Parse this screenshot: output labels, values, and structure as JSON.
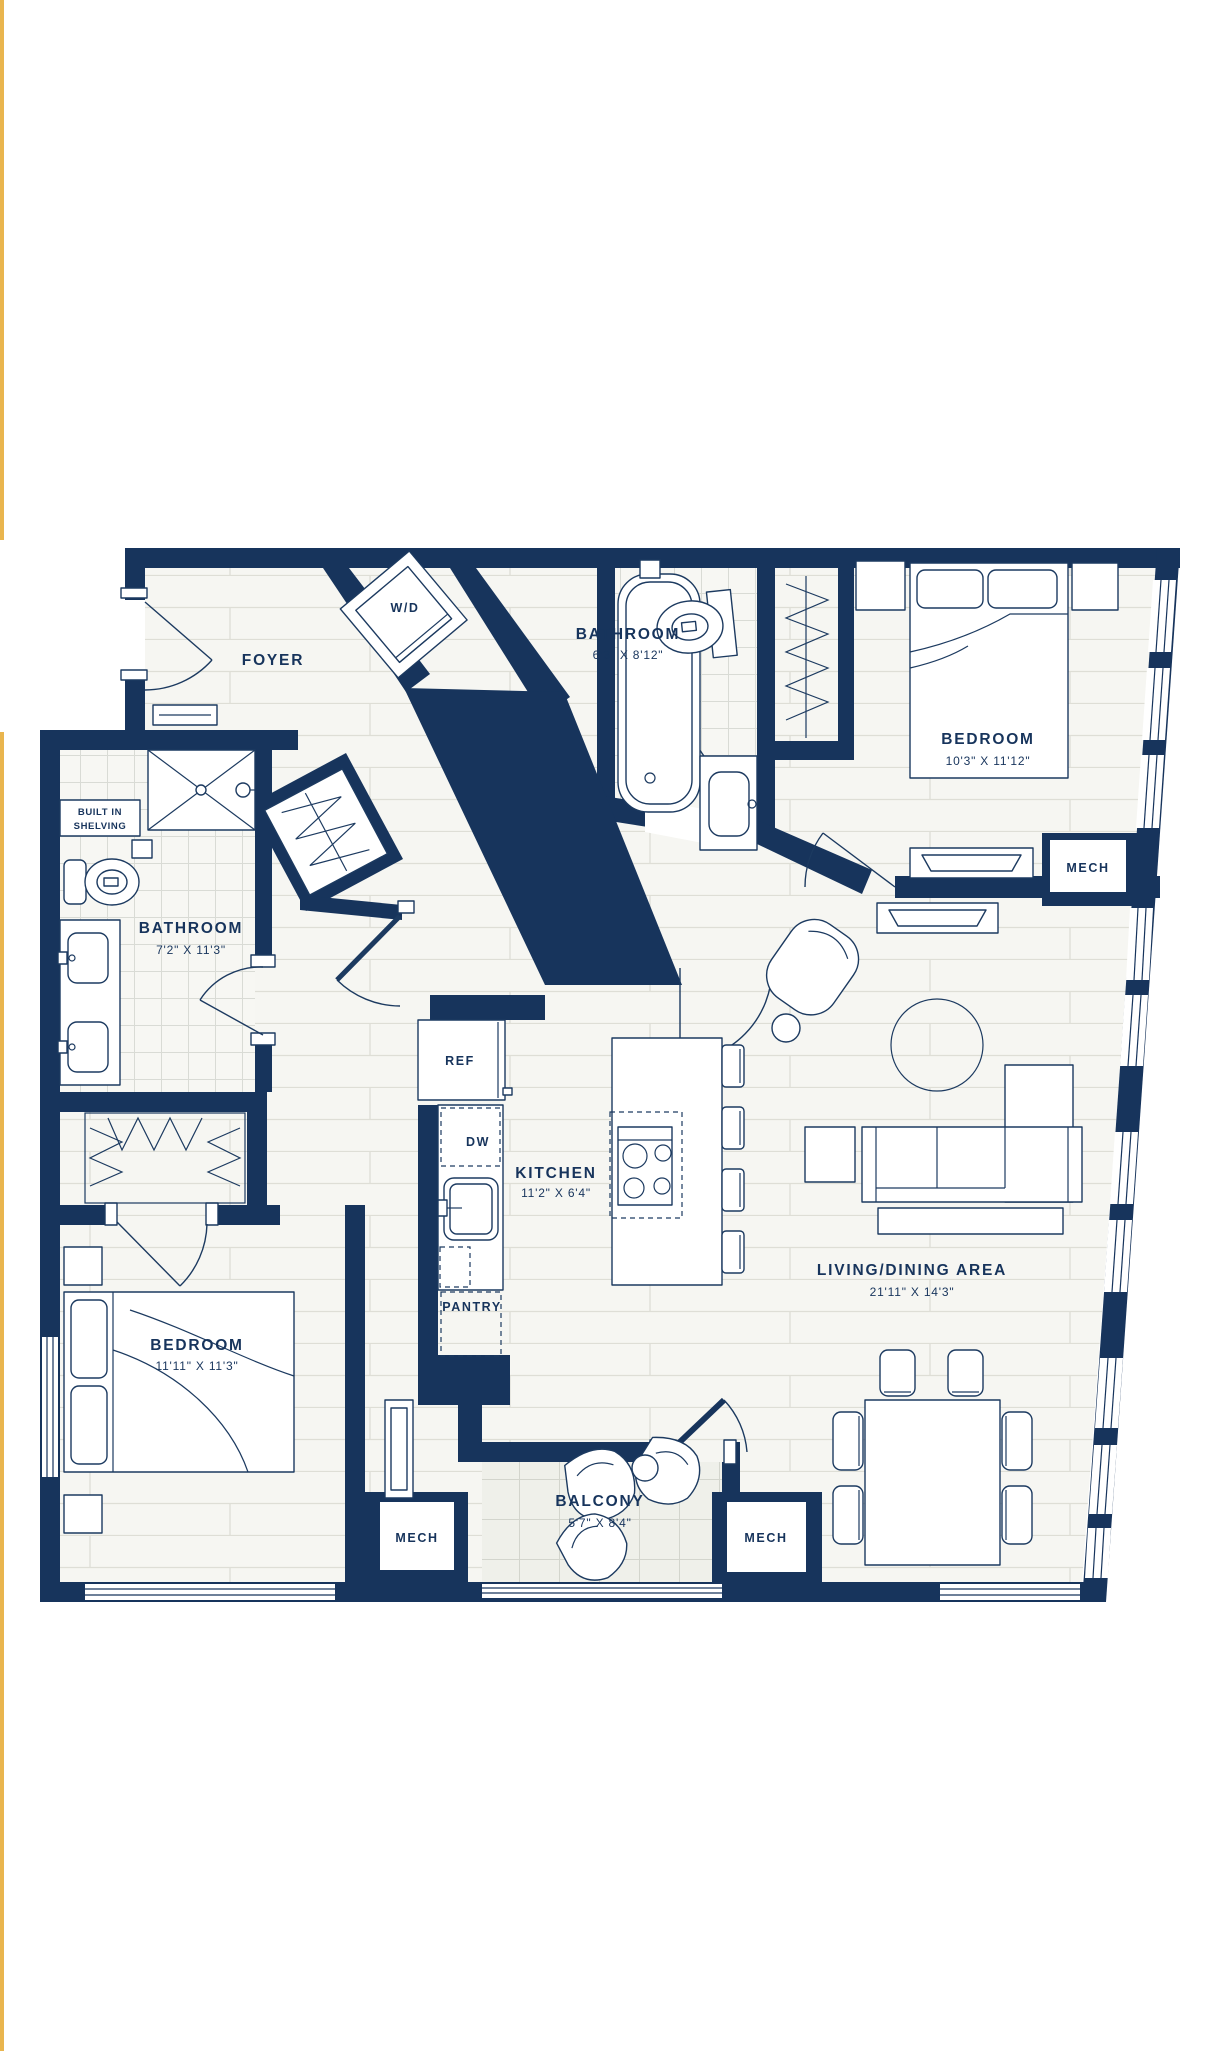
{
  "plan": {
    "foyer": {
      "label": "FOYER"
    },
    "laundry": {
      "label": "W/D"
    },
    "bathroom_top": {
      "label": "BATHROOM",
      "dims": "6'3\" X 8'12\""
    },
    "bedroom_top": {
      "label": "BEDROOM",
      "dims": "10'3\" X 11'12\""
    },
    "mech_bedroom": {
      "label": "MECH"
    },
    "built_in": {
      "line1": "BUILT IN",
      "line2": "SHELVING"
    },
    "bathroom_left": {
      "label": "BATHROOM",
      "dims": "7'2\" X 11'3\""
    },
    "fridge": {
      "label": "REF"
    },
    "dishwasher": {
      "label": "DW"
    },
    "kitchen": {
      "label": "KITCHEN",
      "dims": "11'2\" X 6'4\""
    },
    "pantry": {
      "label": "PANTRY"
    },
    "bedroom_bottom": {
      "label": "BEDROOM",
      "dims": "11'11\" X 11'3\""
    },
    "living": {
      "label": "LIVING/DINING AREA",
      "dims": "21'11\" X 14'3\""
    },
    "balcony": {
      "label": "BALCONY",
      "dims": "5'7\" X 8'4\""
    },
    "mech_left": {
      "label": "MECH"
    },
    "mech_right": {
      "label": "MECH"
    }
  },
  "colors": {
    "wall": "#17345C",
    "accent_stripe": "#E9B54E",
    "floor_line": "#DEDED6",
    "tile_line": "#D9DBD5",
    "background": "#FFFFFF"
  }
}
